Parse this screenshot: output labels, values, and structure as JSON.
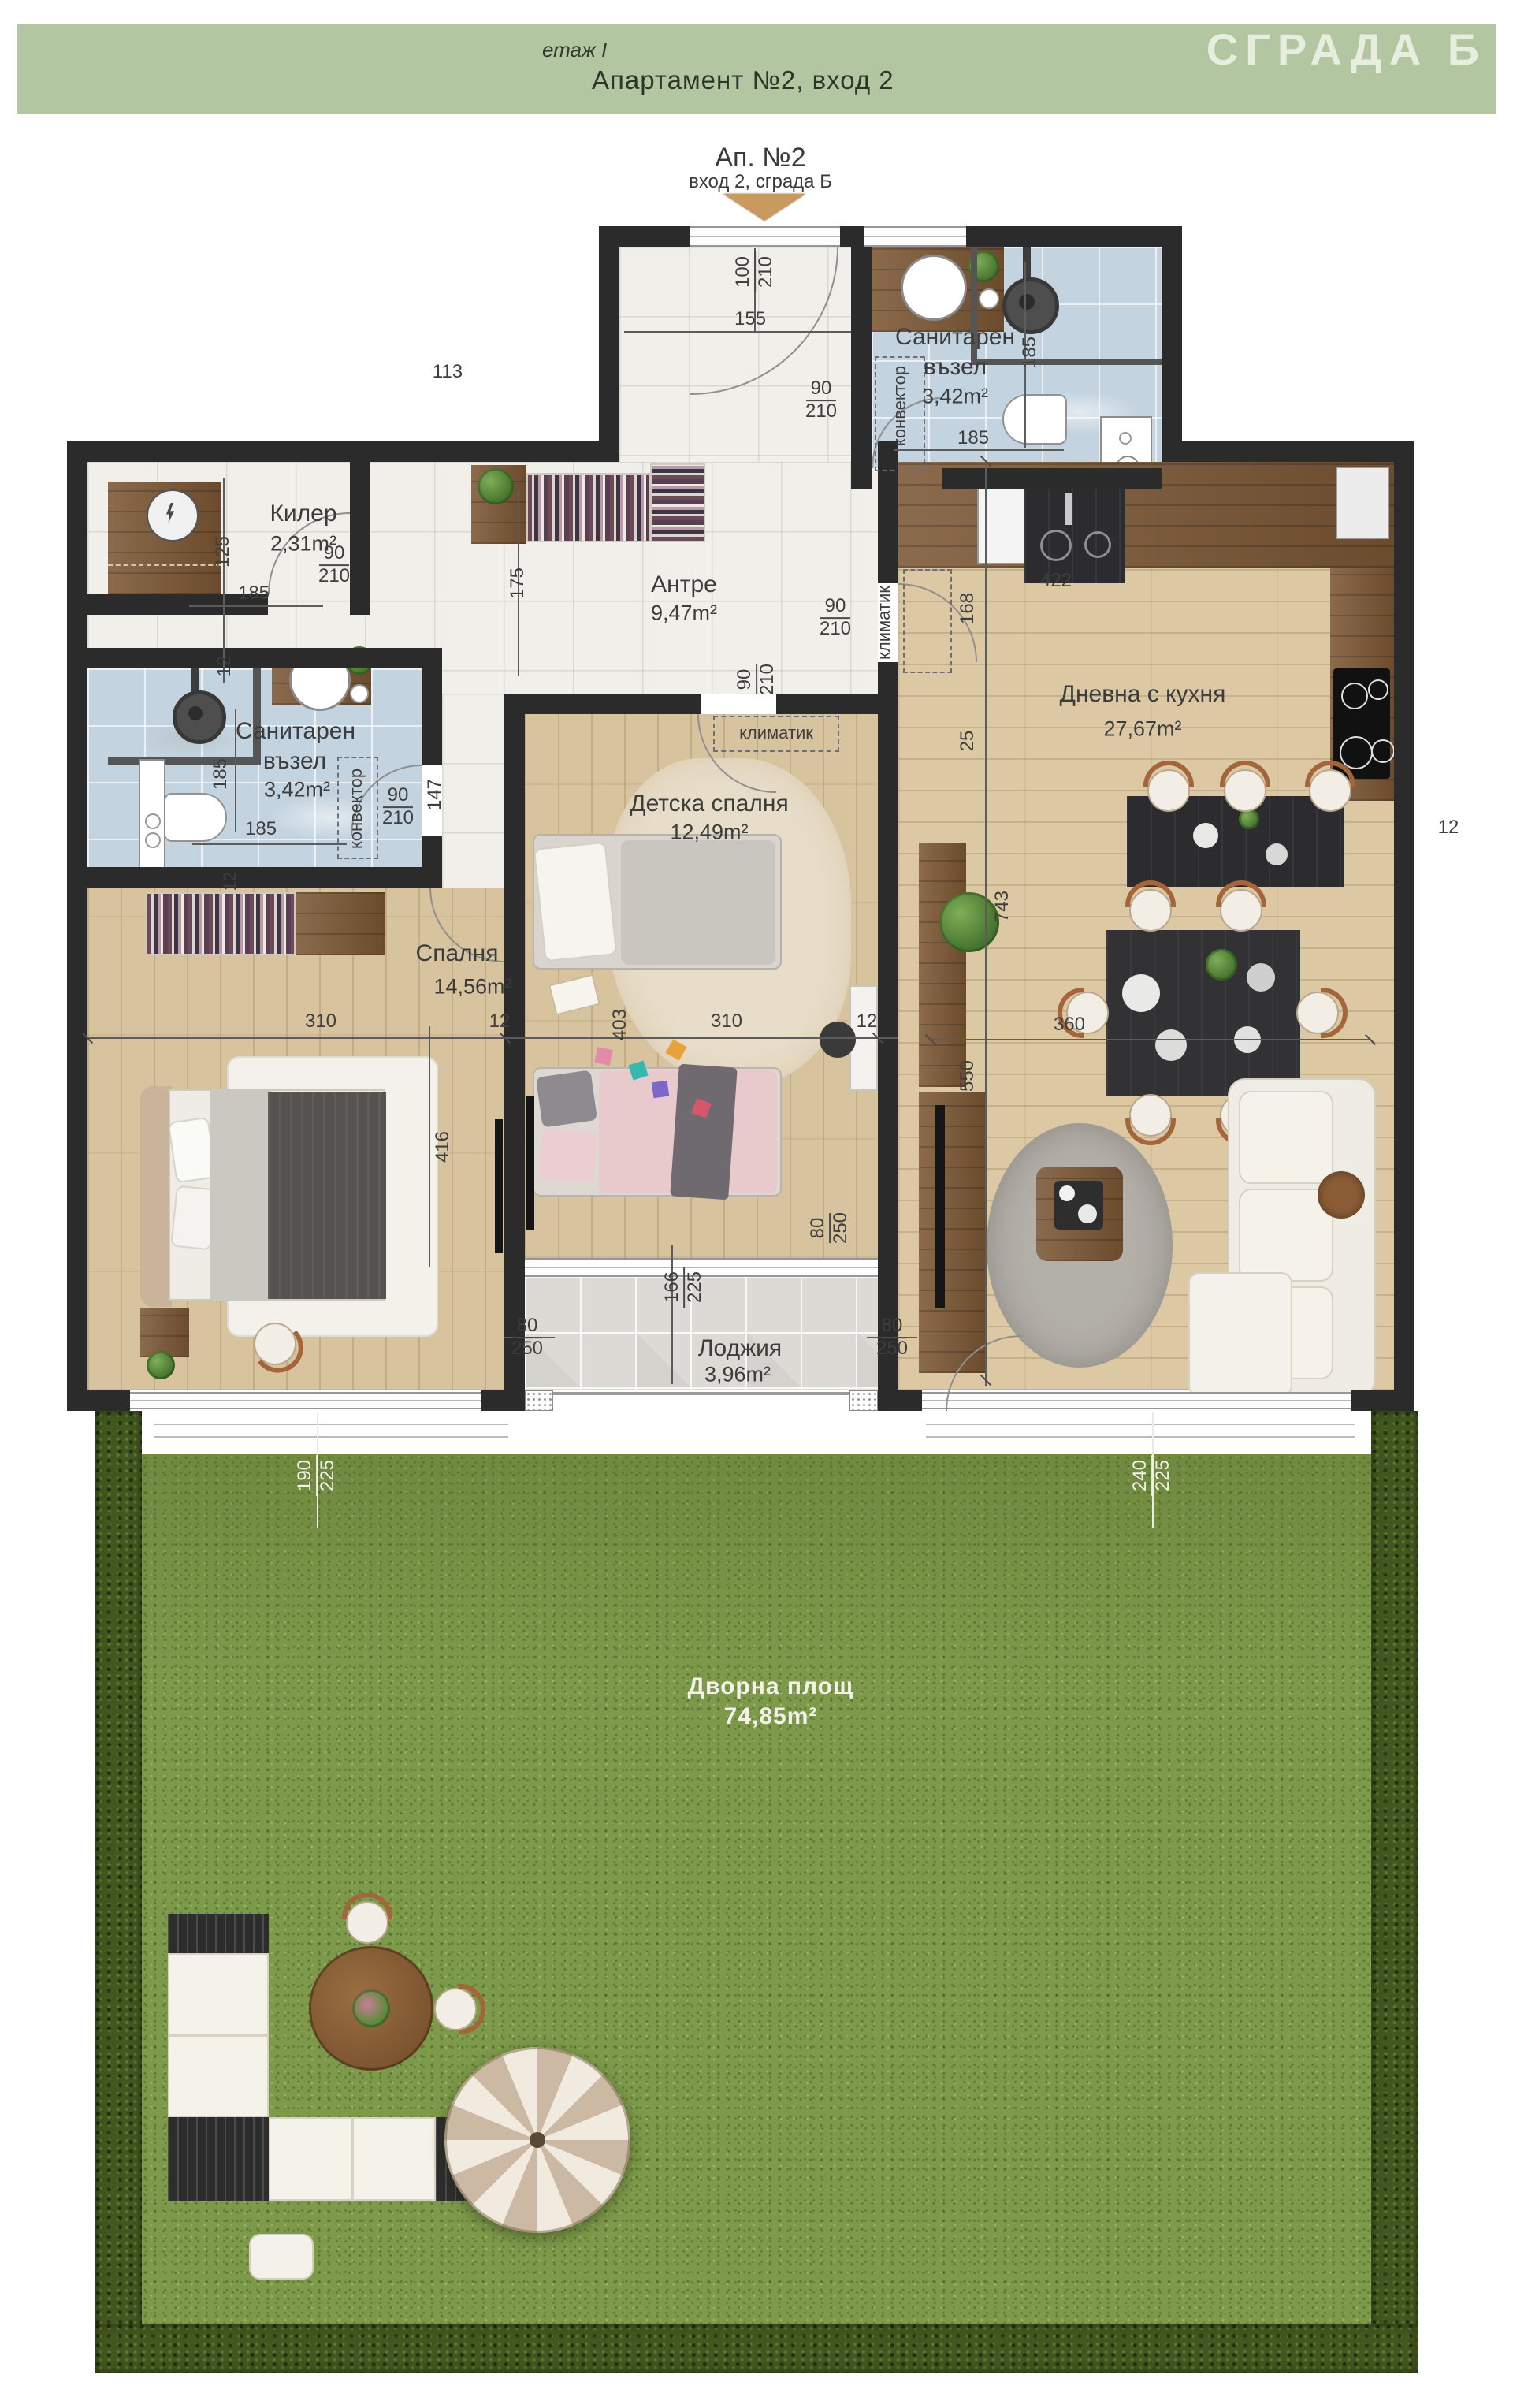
{
  "header": {
    "floor_label": "етаж I",
    "apartment_title": "Апартамент №2, вход 2",
    "building_label": "СГРАДА Б"
  },
  "entrance_callout": {
    "title": "Ап. №2",
    "subtitle": "вход 2, сграда Б"
  },
  "rooms": {
    "bath_top": {
      "line1": "Санитарен",
      "line2": "възел",
      "area": "3,42m²"
    },
    "bath_left": {
      "line1": "Санитарен",
      "line2": "възел",
      "area": "3,42m²"
    },
    "kiler": {
      "name": "Килер",
      "area": "2,31m²"
    },
    "antre": {
      "name": "Антре",
      "area": "9,47m²"
    },
    "living": {
      "name": "Дневна с кухня",
      "area": "27,67m²"
    },
    "kids": {
      "name": "Детска спалня",
      "area": "12,49m²"
    },
    "bedroom": {
      "name": "Спалня",
      "area": "14,56m²"
    },
    "loggia": {
      "name": "Лоджия",
      "area": "3,96m²"
    },
    "yard": {
      "name": "Дворна площ",
      "area": "74,85m²"
    }
  },
  "labels": {
    "konvektor": "конвектор",
    "klimatik": "климатик"
  },
  "dims": {
    "n12": "12",
    "n25": "25",
    "n80": "80",
    "n90": "90",
    "n100": "100",
    "n113": "113",
    "n125": "125",
    "n147": "147",
    "n155": "155",
    "n166": "166",
    "n168": "168",
    "n175": "175",
    "n185": "185",
    "n190": "190",
    "n210": "210",
    "n225": "225",
    "n240": "240",
    "n250": "250",
    "n310": "310",
    "n360": "360",
    "n403": "403",
    "n416": "416",
    "n422": "422",
    "n550": "550",
    "n743": "743"
  },
  "colors": {
    "header_green": "#b3c6a2",
    "wall": "#2b2b2b",
    "grass": "#7d9a4b",
    "hedge": "#42571f",
    "tile": "#f1efe9",
    "bath_tile": "#c3d3df",
    "wood": "#d7c49e",
    "accent_wood": "#7b5634"
  }
}
